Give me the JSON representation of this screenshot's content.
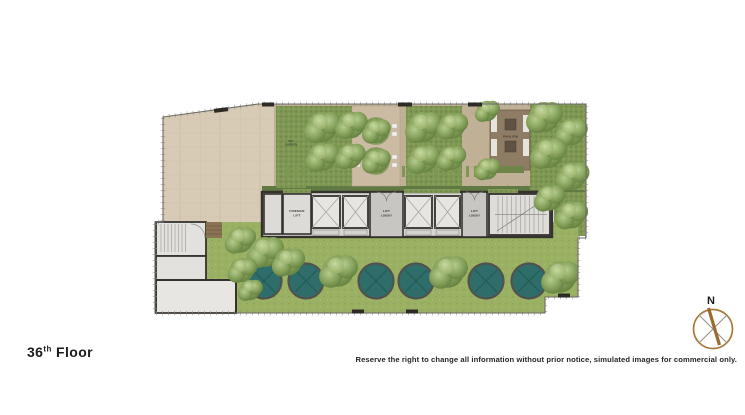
{
  "page": {
    "background": "#ffffff",
    "floor_title": {
      "number": "36",
      "ordinal": "th",
      "word": "Floor"
    },
    "disclaimer": "Reserve the right to change all information without prior notice, simulated images for commercial only.",
    "compass": {
      "north_label": "N"
    }
  },
  "plan": {
    "rooms": {
      "fireman_lift": {
        "line1": "FIREMAN",
        "line2": "LIFT"
      },
      "lift_lobby_a": {
        "line1": "LIFT",
        "line2": "LOBBY"
      },
      "lift_lobby_b": {
        "line1": "LIFT",
        "line2": "LOBBY"
      },
      "pavilion": {
        "label": "PAVILION"
      },
      "sky_garden": {
        "line1": "SKY",
        "line2": "GARDEN"
      }
    },
    "features": {
      "round_pools": 6,
      "lift_shafts": 4,
      "staircases": 2
    },
    "colors": {
      "deck": "#d8cbb5",
      "path": "#c0b096",
      "lawn": "#9ab163",
      "hedge": "#7e9753",
      "hedge_dark": "#617a43",
      "pool": "#2e6d69",
      "wall": "#35322e",
      "room": "#dcdbd8",
      "pavilion_deck": "#8f7c64",
      "compass_needle": "#9c6b2f"
    }
  }
}
